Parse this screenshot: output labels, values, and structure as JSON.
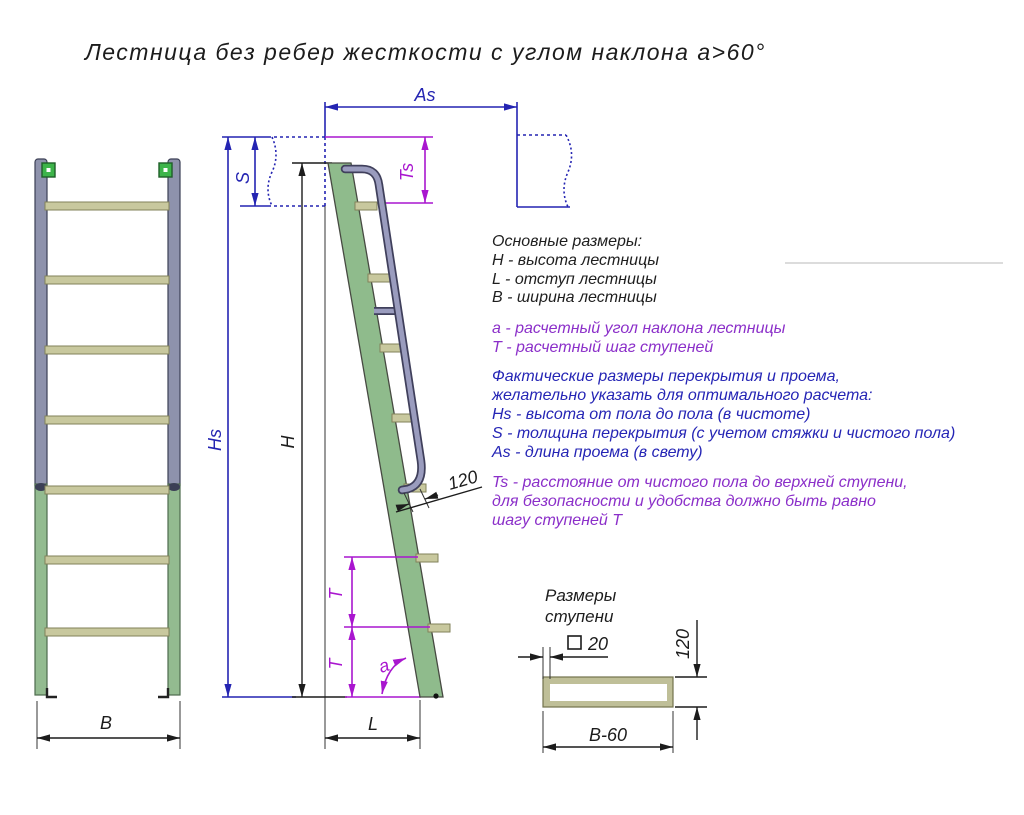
{
  "title": "Лестница без ребер жесткости с углом наклона a>60°",
  "notes": {
    "basic_header": "Основные размеры:",
    "basic": [
      "H - высота лестницы",
      "L - отступ лестницы",
      "B - ширина лестницы"
    ],
    "calc": [
      "a - расчетный угол наклона лестницы",
      "T - расчетный шаг ступеней"
    ],
    "actual": [
      "Фактические размеры перекрытия и проема,",
      "желательно указать для оптимального расчета:",
      "Hs - высота от пола до пола (в чистоте)",
      "S - толщина перекрытия (с учетом стяжки и чистого пола)",
      "As - длина проема (в свету)"
    ],
    "ts_note": [
      "Ts - расстояние от чистого пола до верхней ступени,",
      "для безопасности и удобства должно быть равно",
      "шагу ступеней T"
    ]
  },
  "dim_labels": {
    "as": "As",
    "s": "S",
    "ts": "Ts",
    "hs": "Hs",
    "h": "H",
    "rail_offset": "120",
    "t_upper": "T",
    "t_lower": "T",
    "angle": "a",
    "l": "L",
    "b": "B"
  },
  "step_section": {
    "title_line1": "Размеры",
    "title_line2": "ступени",
    "square_size": "20",
    "height": "120",
    "width": "B-60"
  },
  "colors": {
    "dimension_blue": "#2424b2",
    "dimension_magenta": "#a916cf",
    "note_purple": "#8b2fc9",
    "note_blue": "#2525b5",
    "stringer_green": "#8fbb8c",
    "rung_khaki": "#c8c89e",
    "handrail_gray": "#9a9cbe",
    "bracket_green": "#3db44a"
  }
}
